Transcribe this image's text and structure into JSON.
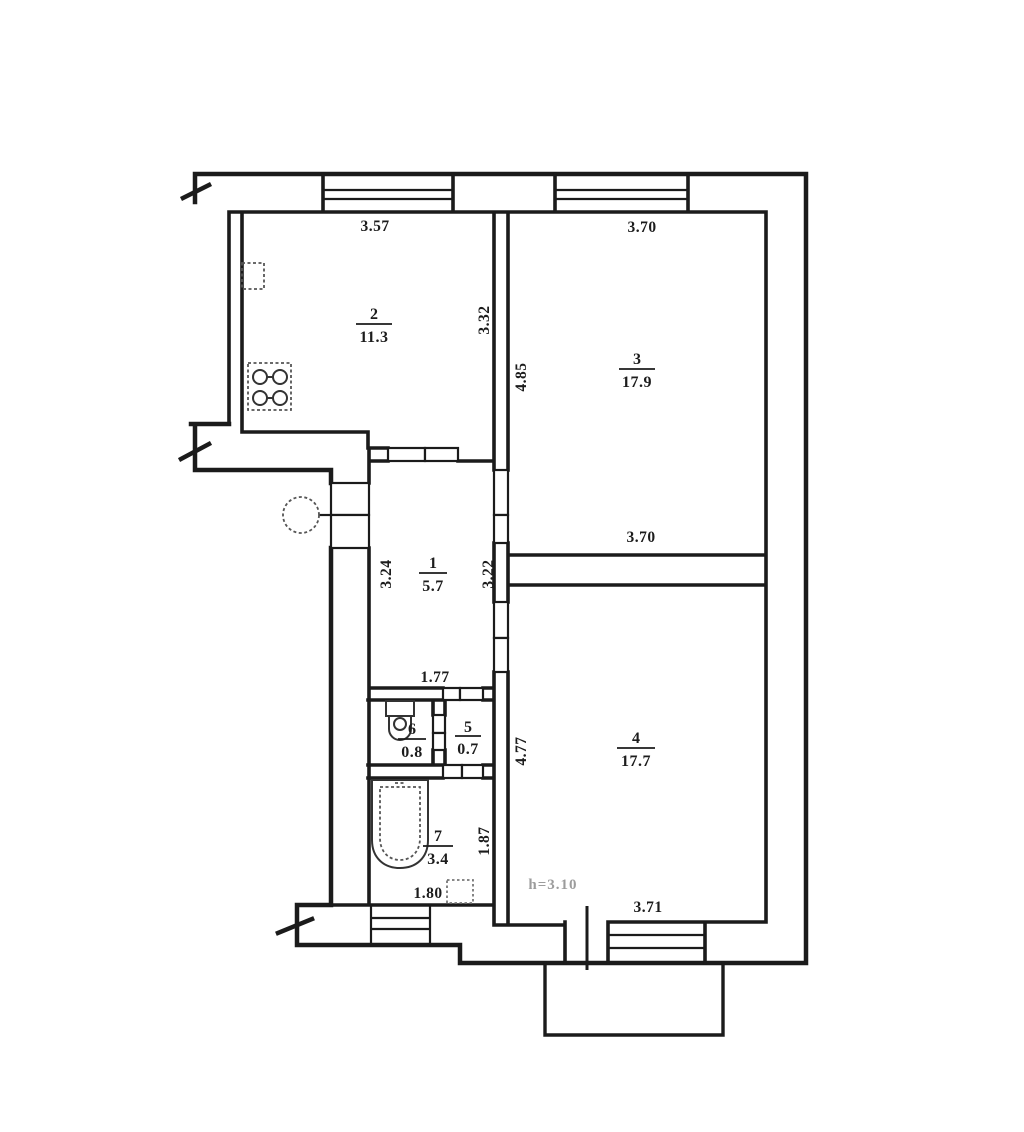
{
  "floor_plan": {
    "type": "apartment-floor-plan-scan",
    "rooms": [
      {
        "number": "1",
        "area": "5.7",
        "dims": {
          "left": "3.24",
          "right": "3.22",
          "bottom": "1.77"
        }
      },
      {
        "number": "2",
        "area": "11.3",
        "dims": {
          "top": "3.57",
          "right": "3.32"
        }
      },
      {
        "number": "3",
        "area": "17.9",
        "dims": {
          "top": "3.70",
          "left": "4.85",
          "bottom": "3.70"
        }
      },
      {
        "number": "4",
        "area": "17.7",
        "dims": {
          "left": "4.77",
          "bottom": "3.71"
        },
        "ceiling_note": "h=3.10"
      },
      {
        "number": "5",
        "area": "0.7"
      },
      {
        "number": "6",
        "area": "0.8"
      },
      {
        "number": "7",
        "area": "3.4",
        "dims": {
          "right": "1.87",
          "bottom": "1.80"
        }
      }
    ],
    "colors": {
      "ink": "#1b1b1b",
      "paper": "#ffffff",
      "faded_text": "#9c9c9c"
    },
    "symbols": [
      "window",
      "door",
      "wall-break",
      "bathtub",
      "toilet",
      "stove",
      "sink",
      "vent-box",
      "column",
      "balcony"
    ]
  }
}
